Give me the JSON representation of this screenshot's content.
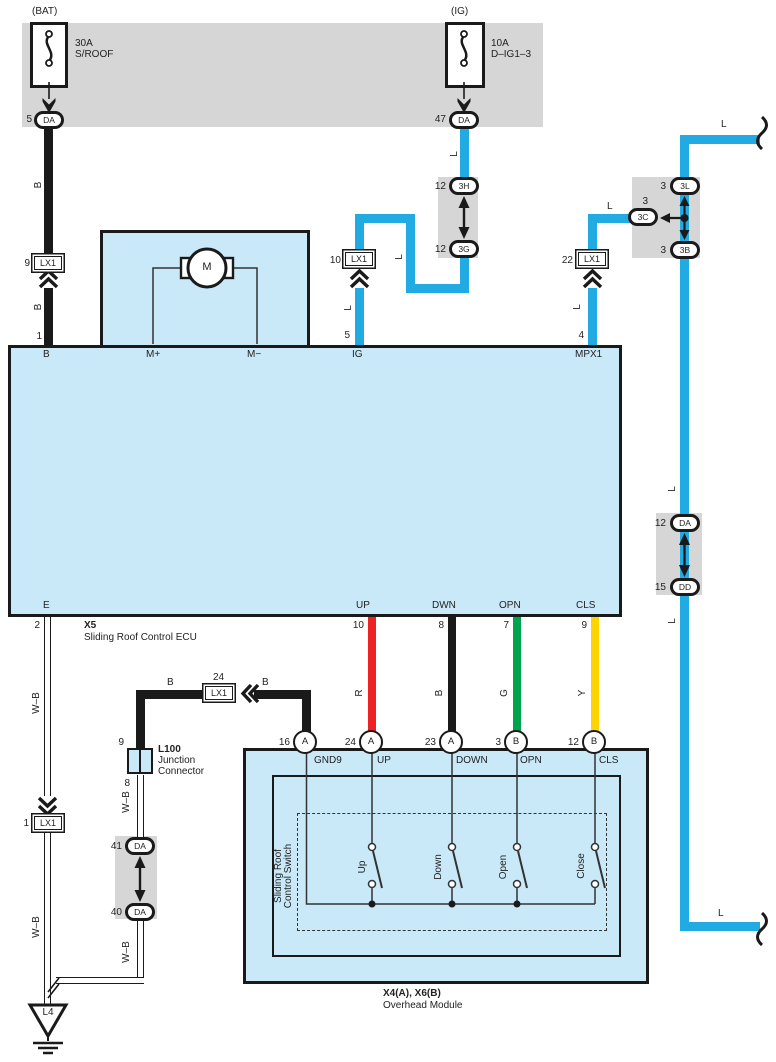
{
  "fuses": {
    "bat": {
      "header": "(BAT)",
      "amp": "30A",
      "name": "S/ROOF"
    },
    "ig": {
      "header": "(IG)",
      "amp": "10A",
      "name": "D–IG1–3"
    }
  },
  "conn": {
    "da5": {
      "pin": "5",
      "code": "DA"
    },
    "da47": {
      "pin": "47",
      "code": "DA"
    },
    "lx9": {
      "pin": "9",
      "code": "LX1"
    },
    "lx10": {
      "pin": "10",
      "code": "LX1"
    },
    "lx22": {
      "pin": "22",
      "code": "LX1"
    },
    "lx24": {
      "pin": "24",
      "code": "LX1"
    },
    "lx1": {
      "pin": "1",
      "code": "LX1"
    },
    "h3": {
      "pin": "12",
      "code": "3H"
    },
    "g3": {
      "pin": "12",
      "code": "3G"
    },
    "l3": {
      "pin": "3",
      "code": "3L"
    },
    "c3": {
      "pin": "3",
      "code": "3C"
    },
    "b3": {
      "pin": "3",
      "code": "3B"
    },
    "da12": {
      "pin": "12",
      "code": "DA"
    },
    "dd15": {
      "pin": "15",
      "code": "DD"
    },
    "da41": {
      "pin": "41",
      "code": "DA"
    },
    "da40": {
      "pin": "40",
      "code": "DA"
    }
  },
  "ecu": {
    "code": "X5",
    "name": "Sliding Roof Control ECU",
    "motor": "M",
    "pins": {
      "b": "B",
      "mplus": "M+",
      "mminus": "M−",
      "ig": "IG",
      "mpx1": "MPX1",
      "e": "E",
      "up": "UP",
      "dwn": "DWN",
      "opn": "OPN",
      "cls": "CLS"
    },
    "nums": {
      "b": "1",
      "ig": "5",
      "mpx1": "4",
      "e": "2",
      "up": "10",
      "dwn": "8",
      "opn": "7",
      "cls": "9"
    }
  },
  "l100": {
    "code": "L100",
    "name1": "Junction",
    "name2": "Connector",
    "pin_top": "9",
    "pin_bottom": "8"
  },
  "module": {
    "code": "X4(A), X6(B)",
    "name": "Overhead Module",
    "sw1": "Sliding Roof",
    "sw2": "Control Switch",
    "pins": {
      "gnd9": {
        "num": "16",
        "conn": "A",
        "label": "GND9"
      },
      "up": {
        "num": "24",
        "conn": "A",
        "label": "UP"
      },
      "down": {
        "num": "23",
        "conn": "A",
        "label": "DOWN"
      },
      "opn": {
        "num": "3",
        "conn": "B",
        "label": "OPN"
      },
      "cls": {
        "num": "12",
        "conn": "B",
        "label": "CLS"
      }
    },
    "switches": {
      "up": "Up",
      "down": "Down",
      "open": "Open",
      "close": "Close"
    }
  },
  "wires": {
    "b": "B",
    "l": "L",
    "r": "R",
    "g": "G",
    "y": "Y",
    "wb": "W–B"
  },
  "ground": {
    "label": "L4"
  },
  "colors": {
    "blue": "#22aae2",
    "red": "#ed2224",
    "green": "#00a44f",
    "yellow": "#fdd400",
    "black": "#1a1a1a",
    "panel_gray": "#d6d6d6",
    "box_fill": "#c9e9f8"
  }
}
